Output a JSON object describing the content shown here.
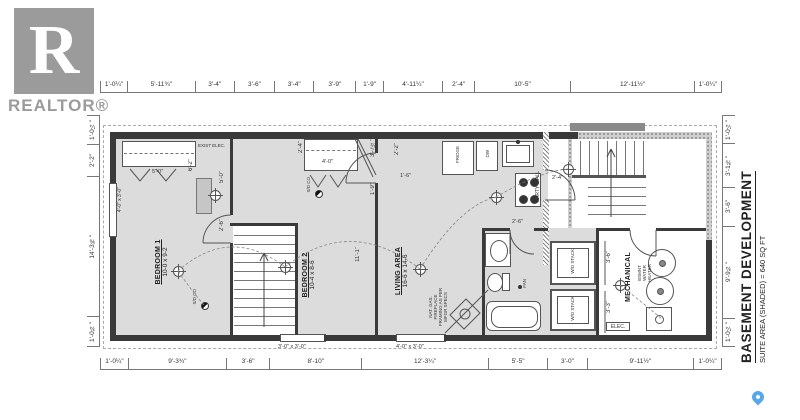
{
  "branding": {
    "logo_letter": "R",
    "realtor_label": "REALTOR®"
  },
  "title_block": {
    "title": "BASEMENT DEVELOPMENT",
    "subtitle": "SUITE AREA (SHADED) = 640 SQ FT"
  },
  "dims": {
    "top": [
      "1'-0¼\"",
      "5'-11¾\"",
      "3'-4\"",
      "3'-6\"",
      "3'-4\"",
      "3'-9\"",
      "1'-9\"",
      "4'-11¼\"",
      "2'-4\"",
      "10'-5\"",
      "12'-11½\"",
      "1'-0¼\""
    ],
    "bottom": [
      "1'-0¼\"",
      "9'-3¾\"",
      "3'-6\"",
      "8'-10\"",
      "12'-3¼\"",
      "5'-5\"",
      "3'-0\"",
      "9'-11½\"",
      "1'-0¼\""
    ],
    "left": [
      "1'-0¼\"",
      "2'-2\"",
      "14'-3⅝\"",
      "1'-0¾\""
    ],
    "right": [
      "1'-0¼\"",
      "3'-1⅜\"",
      "3'-6\"",
      "9'-9¾\"",
      "1'-0¼\""
    ]
  },
  "rooms": {
    "bedroom1": {
      "name": "BEDROOM 1",
      "size": "10-0 x 9-2"
    },
    "bedroom2": {
      "name": "BEDROOM 2",
      "size": "10-4 x 8-6"
    },
    "living": {
      "name": "LIVING AREA",
      "size": "16-6 x 14-6"
    },
    "mechanical": {
      "name": "MECHANICAL"
    }
  },
  "labels": {
    "party_wall": "PARTY WALL",
    "fridge": "FRIDGE",
    "dw": "DW",
    "wd_stack": "W/D STACK",
    "water_heater": "BSMNT WATER HEATER",
    "elec_panel": "ELEC.",
    "exist_elec": "EXIST ELEC.",
    "fan": "FAN",
    "smoke": "S/D CO",
    "fireplace_note": "NAT. GAS. FIREPLACE FRAMING AS PER MFGR SPECS"
  },
  "interior_dims": {
    "closet1_door": "5'-0\"",
    "closet1_depth": "6'-2\"",
    "bed1_win": "5'-0\"",
    "bed1_door": "2'-6\"",
    "closet2_w": "2'-4\"",
    "closet2_len": "4'-0\"",
    "hall_a": "3'-7½\"",
    "hall_b": "1'-9\"",
    "kitchen_return": "2'-2\"",
    "kitchen_door": "1'-6\"",
    "living_len": "11'-1\"",
    "suite_door": "2'-4\"",
    "bath_door": "2'-6\"",
    "wd_a": "3'-6\"",
    "wd_b": "3'-3\""
  },
  "windows": {
    "left": "4'-0\" x 3'-0\"",
    "bottom_a": "3'-0\" x 3'-0\"",
    "bottom_b": "4'-0\" x 3'-0\""
  }
}
